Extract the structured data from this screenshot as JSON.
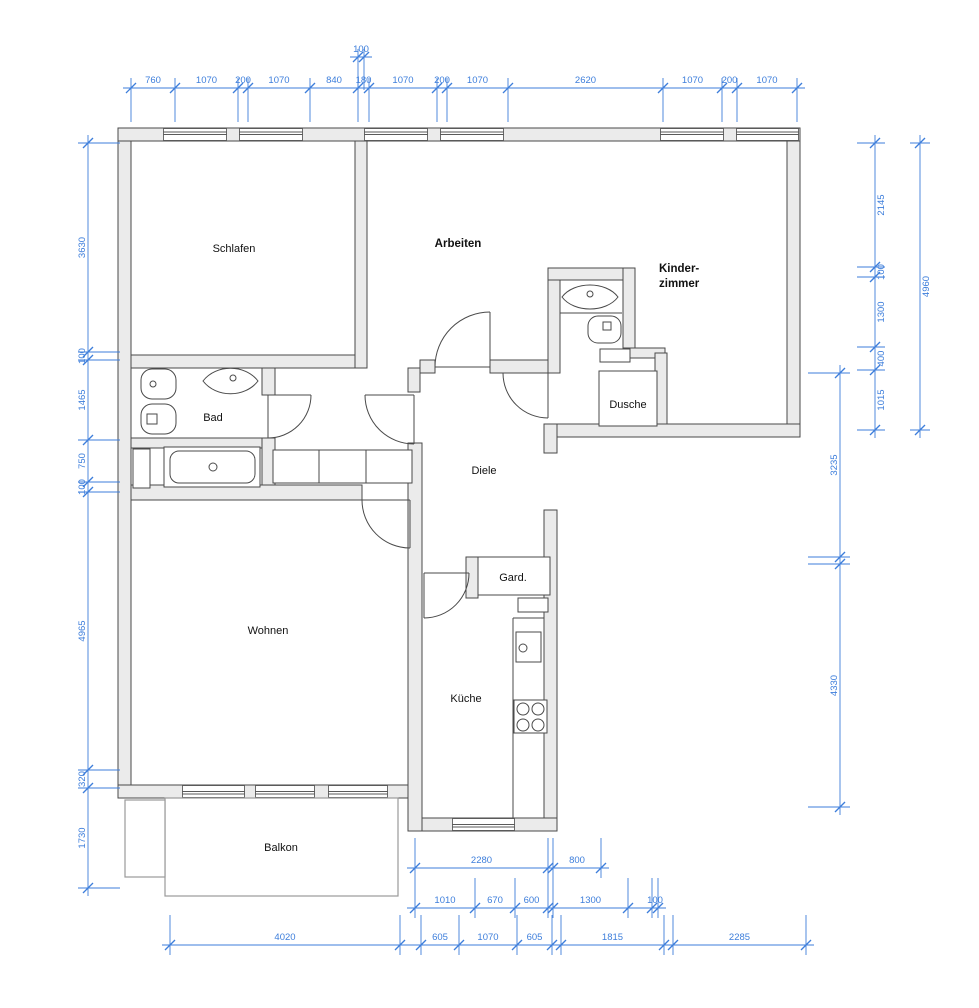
{
  "title": "Wohnungsgrundriss",
  "colors": {
    "dimension_blue": "#3d7edb",
    "wall_fill": "#ebebeb",
    "line_dark": "#4a4a4a"
  },
  "rooms": {
    "schlafen": "Schlafen",
    "arbeiten": "Arbeiten",
    "kinder_line1": "Kinder-",
    "kinder_line2": "zimmer",
    "bad": "Bad",
    "dusche": "Dusche",
    "diele": "Diele",
    "gard": "Gard.",
    "wohnen": "Wohnen",
    "kueche": "Küche",
    "balkon": "Balkon"
  },
  "dimensions": {
    "top": [
      "760",
      "1070",
      "200",
      "1070",
      "840",
      "180",
      "1070",
      "200",
      "1070",
      "2620",
      "1070",
      "200",
      "1070"
    ],
    "top_sub": [
      "100"
    ],
    "left": [
      "3630",
      "100",
      "1465",
      "750",
      "100",
      "4965",
      "320",
      "1730"
    ],
    "right_inner": [
      "2145",
      "100",
      "1300",
      "400",
      "1015"
    ],
    "right_outer": [
      "4960"
    ],
    "right_lower": [
      "3235",
      "4330"
    ],
    "bottom_a": [
      "2280",
      "800"
    ],
    "bottom_b": [
      "1010",
      "670",
      "600",
      "1300",
      "100"
    ],
    "bottom_c": [
      "4020",
      "605",
      "1070",
      "605",
      "1815",
      "2285"
    ]
  }
}
